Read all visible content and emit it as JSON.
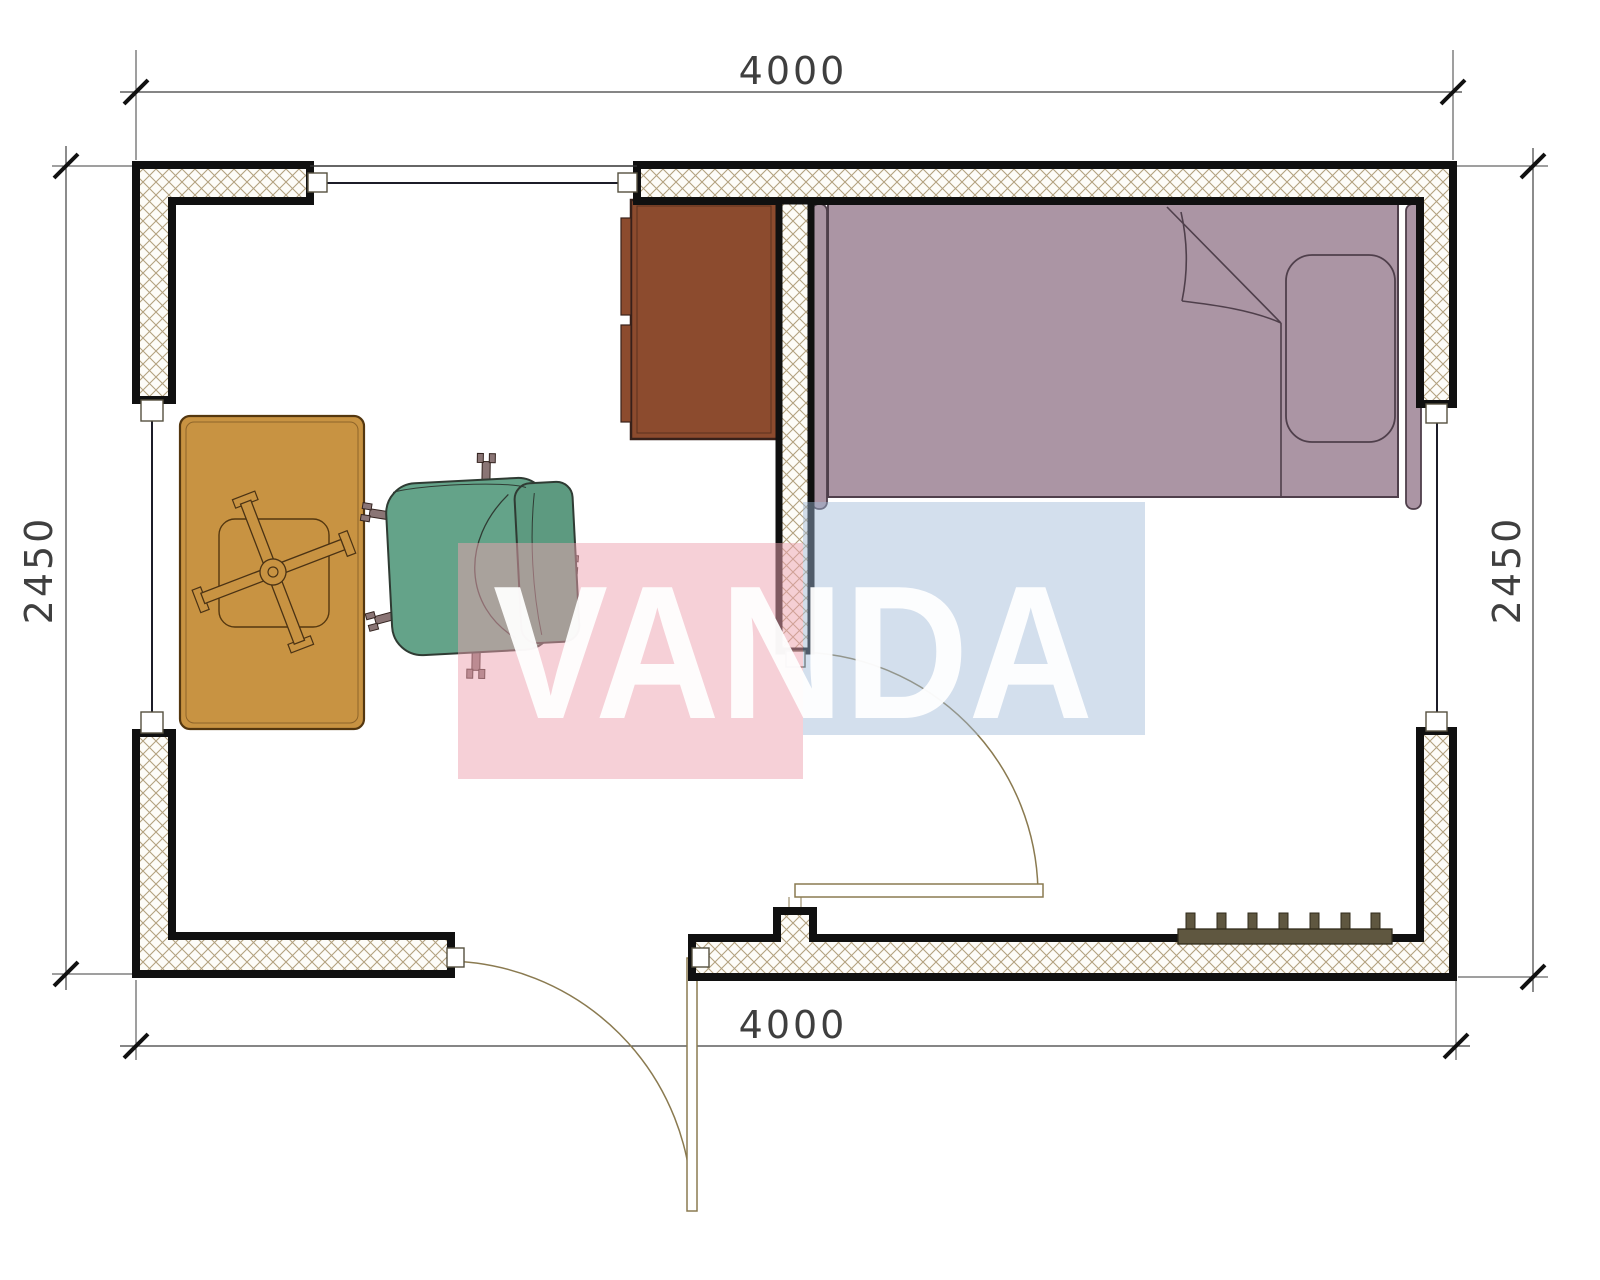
{
  "drawing": {
    "type": "floor-plan",
    "room_width_mm": "4000",
    "room_depth_mm": "2450"
  },
  "dimensions": {
    "top_label": "4000",
    "bottom_label": "4000",
    "left_label": "2450",
    "right_label": "2450"
  },
  "watermark": {
    "text": "VANDA",
    "pink": "#eda1af",
    "blue": "#9eb7d6"
  },
  "colors": {
    "wall_line": "#101010",
    "hatch_line": "#a5916a",
    "hatch_bg": "#fdfcf8",
    "window_line": "#1c1c28",
    "dim_line": "#3f3f3f",
    "door_line": "#8a7a50",
    "bed_fill": "#ab95a4",
    "bed_line": "#4f3f4b",
    "desk_fill": "#8c4b2e",
    "desk_line": "#38211a",
    "table_fill": "#c89342",
    "table_line": "#54370f",
    "chair_fill": "#64a389",
    "chair_back_fill": "#5d9a80",
    "chair_line": "#2f3b33",
    "caster_fill": "#8a7575",
    "radiator_fill": "#5f5740",
    "radiator_line": "#2f2a1a"
  },
  "furniture": [
    {
      "name": "single-bed"
    },
    {
      "name": "wardrobe-cabinet"
    },
    {
      "name": "pedestal-table"
    },
    {
      "name": "office-chair"
    },
    {
      "name": "radiator"
    }
  ],
  "openings": [
    {
      "name": "window-top"
    },
    {
      "name": "window-left"
    },
    {
      "name": "window-right"
    },
    {
      "name": "entry-door"
    },
    {
      "name": "interior-door"
    }
  ]
}
